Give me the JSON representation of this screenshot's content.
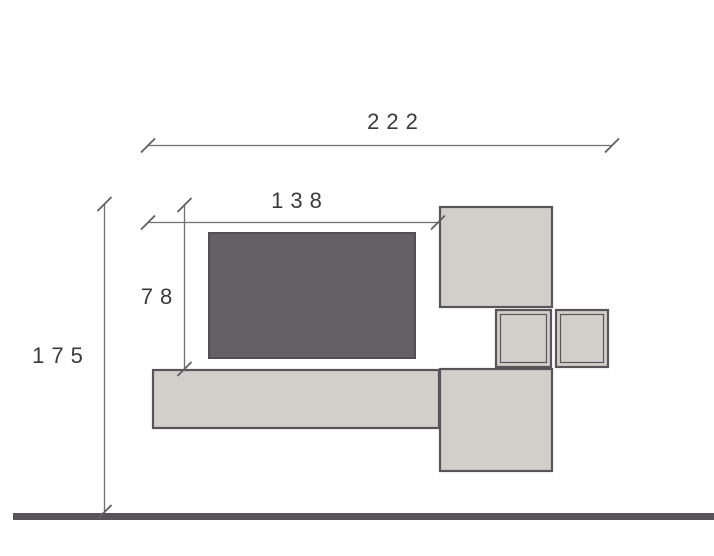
{
  "drawing": {
    "title": "wall-unit-elevation",
    "dimension_labels": {
      "total_width": "222",
      "upper_width": "138",
      "hanging_height": "78",
      "total_height": "175"
    },
    "dimension_values": {
      "total_width": 222,
      "upper_width": 138,
      "hanging_height": 78,
      "total_height": 175
    },
    "colors": {
      "light_fill": "#d2cfca",
      "dark_fill": "#636163",
      "outline": "#57555a",
      "dark_outline": "#514f51",
      "dim_line": "#6f6f6f",
      "tick": "#5f5f5f",
      "text": "#3a3a3a",
      "floor": "#57555a",
      "background": "#ffffff"
    },
    "elements": {
      "tv_panel": "dark back panel",
      "wall_cabinet": "upper right cabinet",
      "cube_shelf_1": "small framed cube left",
      "cube_shelf_2": "small framed cube right",
      "bench": "long low bench",
      "side_column": "lower right column",
      "floor_line": "floor"
    }
  }
}
